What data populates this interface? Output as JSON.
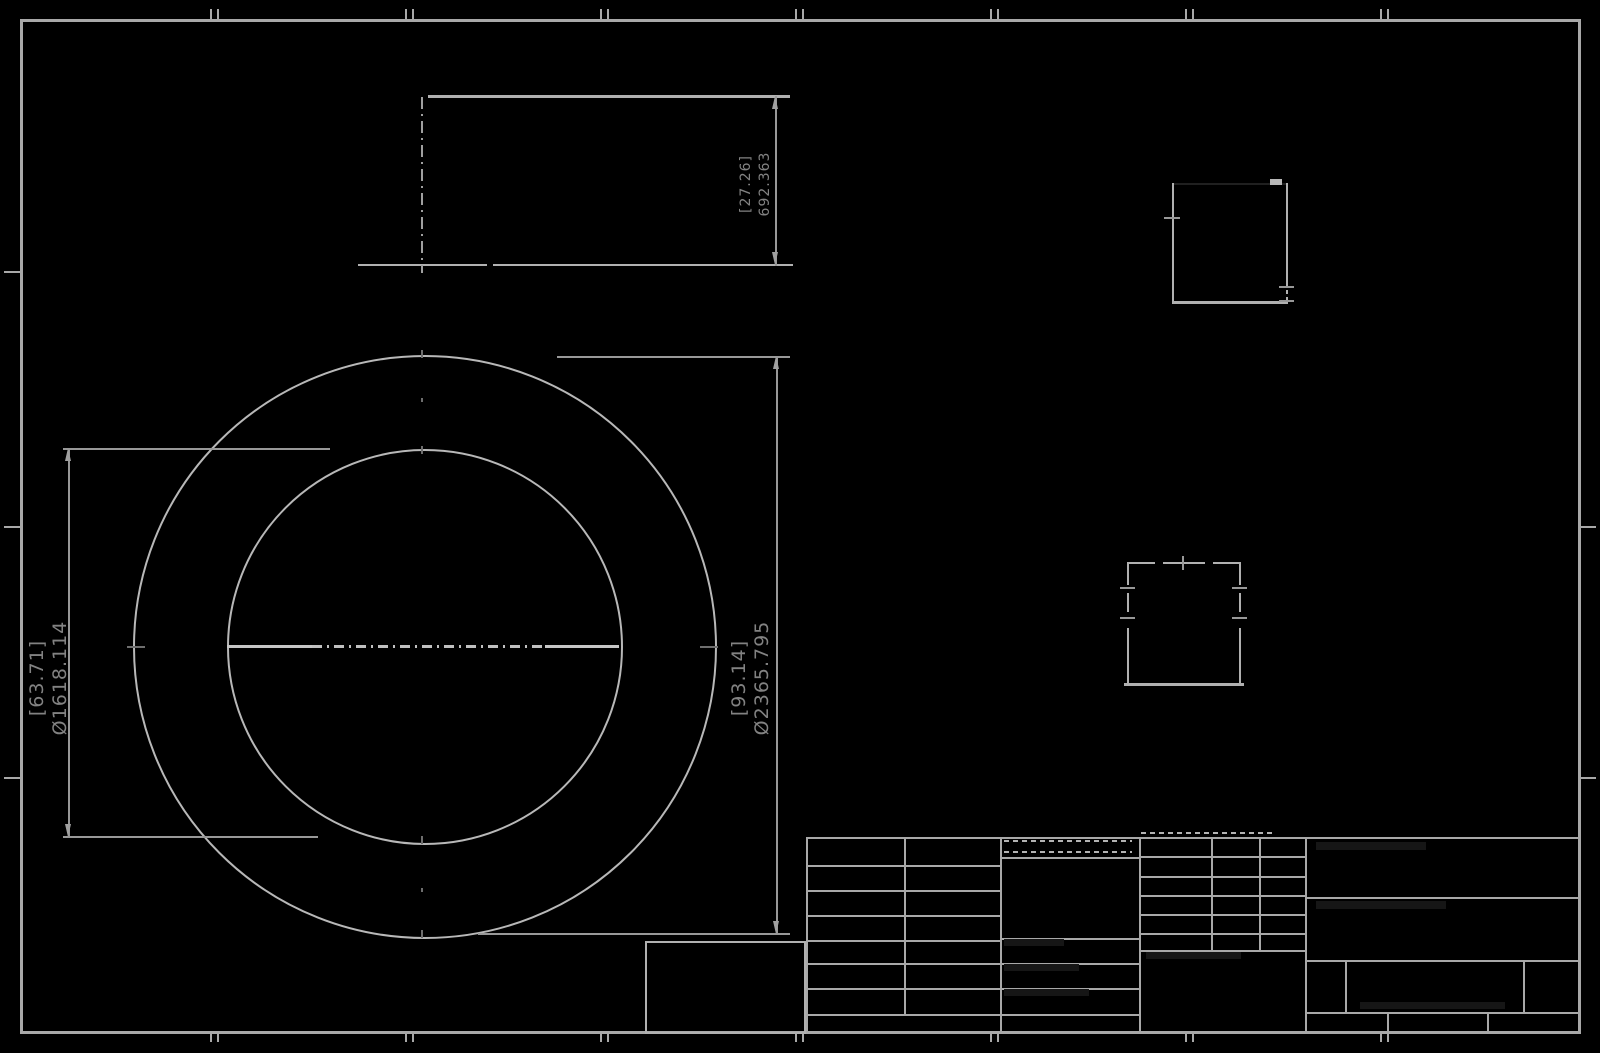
{
  "drawing": {
    "side_view": {
      "height_dim": {
        "inch": "[27.26]",
        "mm": "692.363"
      }
    },
    "plan_view": {
      "inner_diameter": {
        "inch": "[63.71]",
        "mm": "Ø1618.114"
      },
      "outer_diameter": {
        "inch": "[93.14]",
        "mm": "Ø2365.795"
      }
    },
    "colors": {
      "background": "#000000",
      "line": "#a8a8a8",
      "bright_line": "#c6c6c6",
      "text": "#828282"
    }
  }
}
